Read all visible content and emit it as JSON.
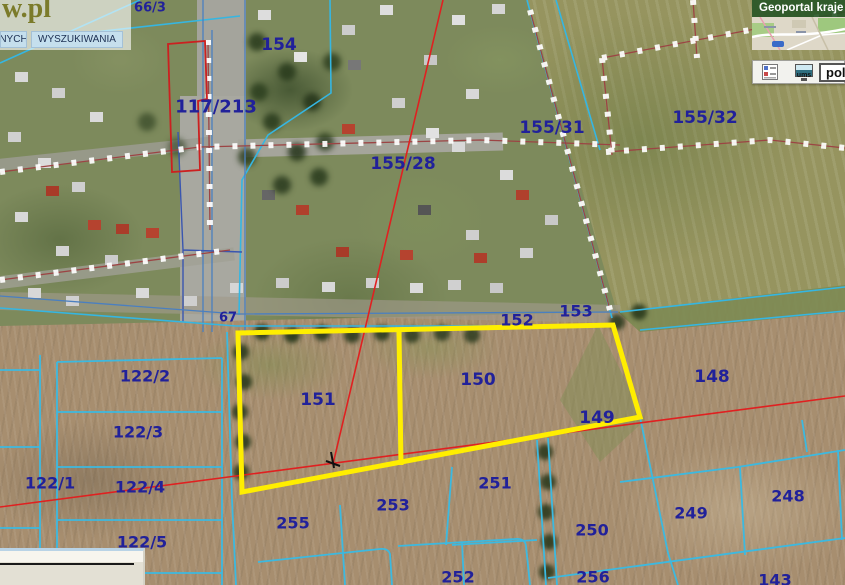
{
  "ui": {
    "top_left": {
      "logo": "w.pl",
      "tabs": [
        {
          "label": "NYCH"
        },
        {
          "label": "WYSZUKIWANIA"
        }
      ]
    },
    "top_right": {
      "title": "Geoportal kraje",
      "ums_label": "ums",
      "lang_value": "pol"
    }
  },
  "map": {
    "parcel_labels": [
      {
        "label": "66/3",
        "x": 150,
        "y": 8,
        "s": 13
      },
      {
        "label": "154",
        "x": 279,
        "y": 45,
        "s": 17
      },
      {
        "label": "117/213",
        "x": 216,
        "y": 107,
        "s": 18
      },
      {
        "label": "155/28",
        "x": 403,
        "y": 164,
        "s": 17
      },
      {
        "label": "155/31",
        "x": 552,
        "y": 128,
        "s": 17
      },
      {
        "label": "155/32",
        "x": 705,
        "y": 118,
        "s": 17
      },
      {
        "label": "67",
        "x": 228,
        "y": 318,
        "s": 13
      },
      {
        "label": "152",
        "x": 517,
        "y": 320,
        "s": 16
      },
      {
        "label": "153",
        "x": 576,
        "y": 311,
        "s": 16
      },
      {
        "label": "151",
        "x": 318,
        "y": 400,
        "s": 17
      },
      {
        "label": "150",
        "x": 478,
        "y": 380,
        "s": 17
      },
      {
        "label": "149",
        "x": 597,
        "y": 418,
        "s": 17
      },
      {
        "label": "148",
        "x": 712,
        "y": 377,
        "s": 17
      },
      {
        "label": "122/2",
        "x": 145,
        "y": 376,
        "s": 16
      },
      {
        "label": "122/3",
        "x": 138,
        "y": 432,
        "s": 16
      },
      {
        "label": "122/1",
        "x": 50,
        "y": 483,
        "s": 16
      },
      {
        "label": "122/4",
        "x": 140,
        "y": 487,
        "s": 16
      },
      {
        "label": "122/5",
        "x": 142,
        "y": 542,
        "s": 16
      },
      {
        "label": "255",
        "x": 293,
        "y": 523,
        "s": 16
      },
      {
        "label": "253",
        "x": 393,
        "y": 505,
        "s": 16
      },
      {
        "label": "251",
        "x": 495,
        "y": 483,
        "s": 16
      },
      {
        "label": "250",
        "x": 592,
        "y": 530,
        "s": 16
      },
      {
        "label": "249",
        "x": 691,
        "y": 513,
        "s": 16
      },
      {
        "label": "248",
        "x": 788,
        "y": 496,
        "s": 16
      },
      {
        "label": "252",
        "x": 458,
        "y": 577,
        "s": 16
      },
      {
        "label": "256",
        "x": 593,
        "y": 577,
        "s": 16
      },
      {
        "label": "143",
        "x": 775,
        "y": 580,
        "s": 16
      }
    ],
    "highlight": {
      "outline_points": "238,333 613,325 640,417 242,492",
      "divider_d": "M399,331 L401,465",
      "color": "#ffee00"
    },
    "red_long_d": "M0,507 L845,396",
    "red_diag_d": "M443,0 L333,464",
    "colors": {
      "parcel_line": "#35b6e2",
      "survey_line": "#9c4444",
      "label_text": "#21219a",
      "red_line": "#e02020",
      "highlight": "#ffee00"
    }
  }
}
